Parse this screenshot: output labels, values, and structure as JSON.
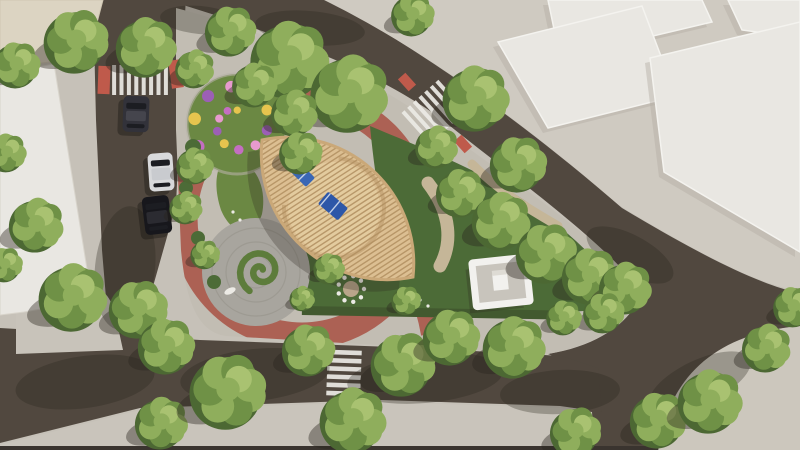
{
  "meta": {
    "description": "Aerial 3D architectural rendering of an urban pocket park with a boat-shaped wooden pergola, circular red pathway, flower spiral, trees, roads, crosswalks and parked cars",
    "width": 800,
    "height": 450
  },
  "palette": {
    "base": "#c6c1b8",
    "road": "#51483f",
    "park_paving": "#c2bdb3",
    "zone": "#cfcac1",
    "island": "#ccc7bd",
    "corner": "#c8c3ba",
    "band": "#c9c4bb",
    "strip": "#3a342f",
    "bldg_white": "#e9e7e2",
    "bldg_edge": "#f4f3ef",
    "bldg_shade": "#b3aea4",
    "beige": "#dcd4c2",
    "red_path": "#ac6154",
    "red_pad": "#bf5a4b",
    "lawn": "#6b8843",
    "lawn_dark": "#4c6b37",
    "lawn_light": "#8aa055",
    "hedge": "#42592f",
    "plaza": "#a8a59e",
    "plaza_line": "#98958d",
    "wood": "#dcbf92",
    "wood_slat": "#b18f60",
    "wood_rim": "#caa878",
    "sand": "#e3cb9e",
    "arc": "#c9a97b",
    "sail": "#3a67b5",
    "sail2": "#2d57a8",
    "sail_stripe": "#e8edf5",
    "kiosk_wall": "#f2f1ee",
    "kiosk_floor": "#c8c4bc",
    "tree_base": "#6f9146",
    "tree_light": "#8fae5c",
    "tree_lighter": "#a9c271",
    "tree_dark": "#4c6833",
    "tree_shadow": "rgba(42,38,30,0.40)",
    "obj_shadow": "rgba(45,40,33,0.28)",
    "bench": "#8a6a4a",
    "white": "#eceae5",
    "flower_colors": [
      "#c46ec2",
      "#e6c44e",
      "#9c5fb5",
      "#e79ace"
    ]
  },
  "ground": {
    "roads": [
      {
        "name": "left",
        "d": "M93,-5 L186,-5 L179,140 L176,205 L152,290 L172,342 L110,346 L102,250 L96,120 Z"
      },
      {
        "name": "top-right",
        "d": "M93,-4 L322,-4 C402,40 502,104 622,208 C702,256 758,284 802,294 L802,326 C740,330 692,362 658,452 L572,452 C584,392 576,364 548,354 C598,346 632,322 642,292 C602,240 520,182 440,118 C360,60 240,22 160,-2 Z"
      },
      {
        "name": "bottom",
        "d": "M0,328 L200,340 L420,348 L562,356 L598,368 L602,412 L560,406 L380,400 L140,408 L0,443 Z"
      }
    ],
    "overlays": [
      {
        "name": "sidewalk-zone-topright",
        "fill": "zone",
        "d": "M320,-2 L802,-2 L802,292 C756,284 700,254 620,206 C500,102 402,38 320,-2 Z"
      },
      {
        "name": "park-ground",
        "fill": "park_paving",
        "d": "M176,8 C250,28 340,58 432,122 C520,186 602,240 642,292 C632,322 594,346 548,354 L360,344 L226,336 C198,332 186,302 181,250 L176,130 Z"
      },
      {
        "name": "junction-corner-west",
        "fill": "corner",
        "d": "M16,276 L90,286 C106,289 112,300 116,318 L123,350 L16,354 Z"
      },
      {
        "name": "sidewalk-band-bottom",
        "fill": "band",
        "d": "M0,445 L140,410 L380,402 L560,408 L592,412 L594,447 L0,447 Z"
      },
      {
        "name": "road-edge-strip-bottom",
        "fill": "strip",
        "d": "M0,446 L800,446 L800,450 L0,450 Z"
      },
      {
        "name": "corner-island-bottomright",
        "fill": "island",
        "d": "M658,452 C668,372 722,332 802,326 L802,452 Z"
      }
    ]
  },
  "buildings": {
    "beige_topleft": {
      "points": "0,0 103,0 94,34 50,62 0,68"
    },
    "white_left": {
      "points": "0,74 54,64 92,300 24,312 0,315"
    },
    "blocks": [
      {
        "points": "548,0 702,0 712,22 560,58"
      },
      {
        "points": "728,0 800,0 800,38 742,30"
      },
      {
        "points": "498,42 642,6 676,96 548,128"
      },
      {
        "points": "650,58 800,22 800,252 664,172"
      }
    ]
  },
  "park": {
    "red_ring": {
      "cx": 302,
      "cy": 218,
      "r": 118,
      "width": 27
    },
    "red_spur": {
      "d": "M390,242 C412,272 424,300 430,334",
      "width": 18
    },
    "flower_circle": {
      "cx": 237,
      "cy": 124,
      "r": 50
    },
    "flower_spiral": {
      "cx": 237,
      "cy": 124,
      "count": 14,
      "a0": 150,
      "astep": 37,
      "r0": 45,
      "rstep": 2.4,
      "s0": 6.5,
      "sstep": 0.22
    },
    "plaza": {
      "cx": 256,
      "cy": 272,
      "r": 54,
      "arc_radii": [
        16,
        30,
        44
      ]
    },
    "spiral_hedge": {
      "cx": 261,
      "cy": 271,
      "r0": 23,
      "turns_deg": 560
    },
    "lawns": [
      {
        "name": "lawn-west",
        "d": "M226,158 C252,156 268,184 262,214 C254,240 232,236 221,210 C213,186 216,166 226,158 Z",
        "fill": "lawn"
      },
      {
        "name": "lawn-northeast",
        "d": "M370,126 C432,152 475,168 524,200 C572,234 610,268 620,300 C598,316 560,310 520,314 C474,319 432,314 410,306 C392,266 378,210 370,126 Z",
        "fill": "lawn_dark"
      },
      {
        "name": "lawn-south",
        "d": "M298,242 C330,252 368,256 396,262 C410,290 414,306 412,312 C370,314 330,312 306,310 C292,282 292,260 298,242 Z",
        "fill": "lawn_dark"
      }
    ],
    "lawn_blobs": [
      [
        208,
        262,
        9
      ],
      [
        224,
        247,
        7
      ]
    ],
    "bushes": [
      [
        193,
        147,
        8
      ],
      [
        186,
        188,
        7
      ],
      [
        198,
        238,
        7
      ],
      [
        214,
        282,
        7
      ],
      [
        330,
        160,
        6
      ],
      [
        372,
        246,
        6
      ]
    ],
    "tan_paths": [
      {
        "d": "M428,183 C452,214 452,244 440,266",
        "w": 13
      },
      {
        "d": "M472,164 C504,196 538,214 558,226",
        "w": 9
      }
    ],
    "hedge_row": {
      "x": 302,
      "y": 306,
      "w": 256,
      "h": 9
    },
    "seat_circle": {
      "cx": 351,
      "cy": 289,
      "r_pad": 8,
      "r_ring": 13,
      "dots": 9
    },
    "benches": [
      {
        "x": 95,
        "y": 196,
        "rot": 85
      },
      {
        "x": 399,
        "y": 271,
        "rot": 18
      },
      {
        "x": 299,
        "y": 93,
        "rot": 75
      },
      {
        "x": 188,
        "y": 79,
        "rot": -20
      }
    ],
    "white_flowers": [
      [
        233,
        212
      ],
      [
        240,
        220
      ],
      [
        370,
        252
      ],
      [
        380,
        256
      ],
      [
        300,
        160
      ],
      [
        296,
        152
      ],
      [
        420,
        300
      ],
      [
        428,
        306
      ]
    ]
  },
  "pergola": {
    "tip1": [
      262,
      140
    ],
    "tip2": [
      413,
      277
    ],
    "R": 126,
    "slat_angle_deg": -33,
    "slat_spacing": 4.3,
    "inner_circle": {
      "cx": 334,
      "cy": 208,
      "r": 46
    },
    "sails": [
      {
        "cx": 302,
        "cy": 174,
        "w": 24,
        "h": 13,
        "rot": 45,
        "fill": "sail"
      },
      {
        "cx": 333,
        "cy": 206,
        "w": 26,
        "h": 16,
        "rot": 40,
        "fill": "sail2"
      }
    ]
  },
  "kiosk": {
    "x": 474,
    "y": 260,
    "w": 54,
    "h": 44,
    "rot": -6,
    "cx": 501,
    "cy": 282
  },
  "crosswalks": [
    {
      "name": "crosswalk-west",
      "cx": 140,
      "cy": 80,
      "rot": 0,
      "n": 8,
      "len": 30,
      "w": 4,
      "gap": 3.4,
      "axis": "x"
    },
    {
      "name": "crosswalk-north",
      "cx": 434,
      "cy": 112,
      "rot": 48,
      "n": 7,
      "len": 42,
      "w": 4,
      "gap": 3.6,
      "axis": "y"
    },
    {
      "name": "crosswalk-south",
      "cx": 344,
      "cy": 373,
      "rot": 2,
      "n": 6,
      "len": 34,
      "w": 4.6,
      "gap": 3.6,
      "axis": "y"
    }
  ],
  "red_pads": [
    {
      "cx": 104,
      "cy": 80,
      "w": 12,
      "h": 28,
      "rot": 2
    },
    {
      "cx": 176,
      "cy": 74,
      "w": 12,
      "h": 28,
      "rot": -8
    },
    {
      "cx": 407,
      "cy": 82,
      "w": 16,
      "h": 10,
      "rot": 48
    },
    {
      "cx": 463,
      "cy": 144,
      "w": 16,
      "h": 10,
      "rot": 48
    }
  ],
  "cars": [
    {
      "name": "car-dark-gray",
      "cx": 136,
      "cy": 114,
      "w": 26,
      "h": 36,
      "rot": 2,
      "body": "#32323a",
      "roof": "#45454d"
    },
    {
      "name": "car-silver",
      "cx": 161,
      "cy": 172,
      "w": 25,
      "h": 38,
      "rot": -4,
      "body": "#d8d9db",
      "roof": "#c9cbcf"
    },
    {
      "name": "car-black",
      "cx": 157,
      "cy": 215,
      "w": 27,
      "h": 38,
      "rot": -7,
      "body": "#17171c",
      "roof": "#2b2b31"
    }
  ],
  "road_shadows": [
    {
      "cx": 125,
      "cy": 268,
      "rx": 30,
      "ry": 62,
      "rot": 6
    },
    {
      "cx": 255,
      "cy": 375,
      "rx": 75,
      "ry": 26,
      "rot": -6
    },
    {
      "cx": 85,
      "cy": 382,
      "rx": 70,
      "ry": 26,
      "rot": -8
    },
    {
      "cx": 425,
      "cy": 378,
      "rx": 78,
      "ry": 25,
      "rot": -5
    },
    {
      "cx": 560,
      "cy": 392,
      "rx": 60,
      "ry": 22,
      "rot": -3
    },
    {
      "cx": 310,
      "cy": 28,
      "rx": 55,
      "ry": 17,
      "rot": 5
    },
    {
      "cx": 200,
      "cy": 20,
      "rx": 40,
      "ry": 14,
      "rot": 5
    },
    {
      "cx": 630,
      "cy": 255,
      "rx": 48,
      "ry": 20,
      "rot": 28
    },
    {
      "cx": 700,
      "cy": 382,
      "rx": 55,
      "ry": 22,
      "rot": -25
    }
  ],
  "trees": [
    [
      78,
      40,
      33
    ],
    [
      18,
      64,
      24
    ],
    [
      148,
      46,
      31
    ],
    [
      196,
      68,
      20
    ],
    [
      232,
      30,
      26
    ],
    [
      292,
      58,
      40
    ],
    [
      352,
      92,
      40
    ],
    [
      414,
      14,
      22
    ],
    [
      256,
      84,
      23
    ],
    [
      296,
      112,
      24
    ],
    [
      302,
      152,
      22
    ],
    [
      478,
      97,
      34
    ],
    [
      438,
      146,
      22
    ],
    [
      520,
      163,
      29
    ],
    [
      8,
      152,
      20
    ],
    [
      38,
      224,
      28
    ],
    [
      6,
      264,
      18
    ],
    [
      196,
      165,
      19
    ],
    [
      187,
      207,
      17
    ],
    [
      206,
      254,
      15
    ],
    [
      330,
      268,
      16
    ],
    [
      303,
      298,
      13
    ],
    [
      407,
      300,
      15
    ],
    [
      462,
      192,
      25
    ],
    [
      503,
      220,
      30
    ],
    [
      548,
      252,
      31
    ],
    [
      592,
      275,
      29
    ],
    [
      627,
      287,
      27
    ],
    [
      605,
      312,
      21
    ],
    [
      565,
      317,
      18
    ],
    [
      75,
      296,
      35
    ],
    [
      140,
      308,
      30
    ],
    [
      168,
      345,
      29
    ],
    [
      163,
      422,
      27
    ],
    [
      230,
      390,
      39
    ],
    [
      310,
      349,
      27
    ],
    [
      355,
      419,
      34
    ],
    [
      405,
      363,
      33
    ],
    [
      453,
      336,
      29
    ],
    [
      516,
      346,
      32
    ],
    [
      577,
      431,
      26
    ],
    [
      660,
      419,
      29
    ],
    [
      712,
      400,
      33
    ],
    [
      768,
      347,
      25
    ],
    [
      795,
      306,
      21
    ]
  ]
}
